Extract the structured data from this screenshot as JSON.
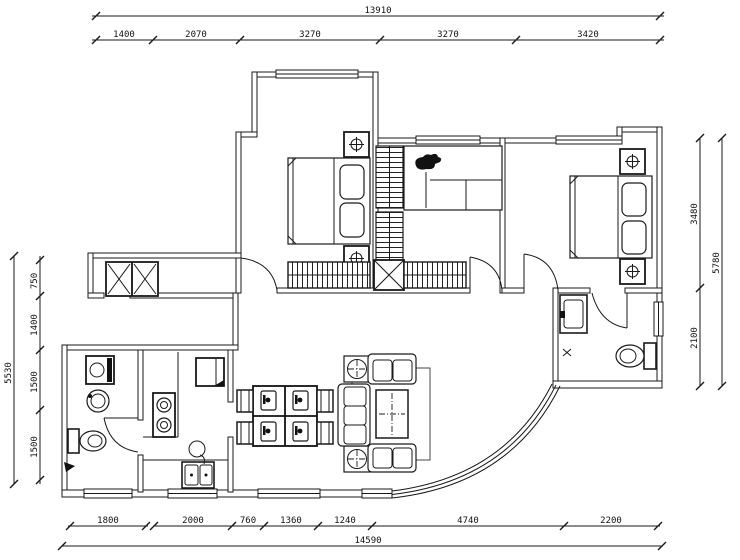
{
  "drawing": {
    "kind": "apartment-floor-plan",
    "line_color": "#1a1a1a",
    "background_color": "#ffffff"
  },
  "dimensions": {
    "top": {
      "total": "13910",
      "segments": [
        "1400",
        "2070",
        "3270",
        "3270",
        "3420"
      ]
    },
    "bottom": {
      "total": "14590",
      "segments": [
        "1800",
        "2000",
        "760",
        "1360",
        "1240",
        "4740",
        "2200"
      ]
    },
    "left": {
      "total": "5530",
      "segments": [
        "750",
        "1400",
        "1500",
        "1500"
      ]
    },
    "right": {
      "total": "5780",
      "segments": [
        "3480",
        "2100"
      ]
    }
  },
  "symbols": {
    "nightstand-glyph": "circled-cross",
    "wardrobe-fill": "vertical-hatch",
    "bookshelf-fill": "horizontal-hatch",
    "shaft-glyph": "x-box",
    "elevator-glyph": "double-x-box"
  }
}
